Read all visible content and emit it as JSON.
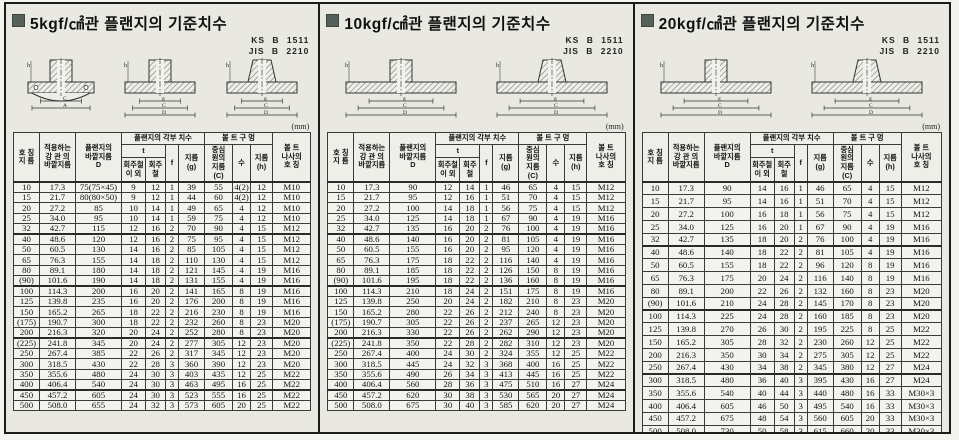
{
  "drawing_labels": {
    "h": "h",
    "g": "g",
    "c": "C",
    "d": "D",
    "a": "A"
  },
  "table_header": {
    "nominal": "호 칭\n지 름",
    "pipe_od": "적용하는\n강 관 의\n바깥지름",
    "flange_od": "플랜지의\n바깥지름\nD",
    "flange_dims_group": "플랜지의 각부 치수",
    "t": "t",
    "t_non_gray_cast": "회주철\n이 외",
    "t_gray_cast": "회주철",
    "f": "f",
    "g": "지름\n(g)",
    "bolt_holes_group": "볼 트 구 멍",
    "bolt_circle": "중심\n원의\n지름\n(C)",
    "count": "수",
    "hole_dia": "지름\n(h)",
    "bolt_thread": "볼 트\n나사의\n호 칭"
  },
  "panels": [
    {
      "title": "5kgf/㎠관 플랜지의 기준치수",
      "standards": [
        "KS B 1511",
        "JIS B 2210"
      ],
      "unit": "(mm)",
      "groups": [
        [
          [
            "10",
            "17.3",
            "75(75×45)",
            "9",
            "12",
            "1",
            "39",
            "55",
            "4(2)",
            "12",
            "M10"
          ],
          [
            "15",
            "21.7",
            "80(80×50)",
            "9",
            "12",
            "1",
            "44",
            "60",
            "4(2)",
            "12",
            "M10"
          ],
          [
            "20",
            "27.2",
            "85",
            "10",
            "14",
            "1",
            "49",
            "65",
            "4",
            "12",
            "M10"
          ],
          [
            "25",
            "34.0",
            "95",
            "10",
            "14",
            "1",
            "59",
            "75",
            "4",
            "12",
            "M10"
          ],
          [
            "32",
            "42.7",
            "115",
            "12",
            "16",
            "2",
            "70",
            "90",
            "4",
            "15",
            "M12"
          ]
        ],
        [
          [
            "40",
            "48.6",
            "120",
            "12",
            "16",
            "2",
            "75",
            "95",
            "4",
            "15",
            "M12"
          ],
          [
            "50",
            "60.5",
            "130",
            "14",
            "16",
            "2",
            "85",
            "105",
            "4",
            "15",
            "M12"
          ],
          [
            "65",
            "76.3",
            "155",
            "14",
            "18",
            "2",
            "110",
            "130",
            "4",
            "15",
            "M12"
          ],
          [
            "80",
            "89.1",
            "180",
            "14",
            "18",
            "2",
            "121",
            "145",
            "4",
            "19",
            "M16"
          ],
          [
            "(90)",
            "101.6",
            "190",
            "14",
            "18",
            "2",
            "131",
            "155",
            "4",
            "19",
            "M16"
          ]
        ],
        [
          [
            "100",
            "114.3",
            "200",
            "16",
            "20",
            "2",
            "141",
            "165",
            "8",
            "19",
            "M16"
          ],
          [
            "125",
            "139.8",
            "235",
            "16",
            "20",
            "2",
            "176",
            "200",
            "8",
            "19",
            "M16"
          ],
          [
            "150",
            "165.2",
            "265",
            "18",
            "22",
            "2",
            "216",
            "230",
            "8",
            "19",
            "M16"
          ],
          [
            "(175)",
            "190.7",
            "300",
            "18",
            "22",
            "2",
            "232",
            "260",
            "8",
            "23",
            "M20"
          ],
          [
            "200",
            "216.3",
            "320",
            "20",
            "24",
            "2",
            "252",
            "280",
            "8",
            "23",
            "M20"
          ]
        ],
        [
          [
            "(225)",
            "241.8",
            "345",
            "20",
            "24",
            "2",
            "277",
            "305",
            "12",
            "23",
            "M20"
          ],
          [
            "250",
            "267.4",
            "385",
            "22",
            "26",
            "2",
            "317",
            "345",
            "12",
            "23",
            "M20"
          ],
          [
            "300",
            "318.5",
            "430",
            "22",
            "28",
            "3",
            "360",
            "390",
            "12",
            "23",
            "M20"
          ],
          [
            "350",
            "355.6",
            "480",
            "24",
            "30",
            "3",
            "403",
            "435",
            "12",
            "25",
            "M22"
          ],
          [
            "400",
            "406.4",
            "540",
            "24",
            "30",
            "3",
            "463",
            "495",
            "16",
            "25",
            "M22"
          ]
        ],
        [
          [
            "450",
            "457.2",
            "605",
            "24",
            "30",
            "3",
            "523",
            "555",
            "16",
            "25",
            "M22"
          ],
          [
            "500",
            "508.0",
            "655",
            "24",
            "32",
            "3",
            "573",
            "605",
            "20",
            "25",
            "M22"
          ]
        ]
      ]
    },
    {
      "title": "10kgf/㎠관 플랜지의 기준치수",
      "standards": [
        "KS B 1511",
        "JIS B 2210"
      ],
      "unit": "(mm)",
      "groups": [
        [
          [
            "10",
            "17.3",
            "90",
            "12",
            "14",
            "1",
            "46",
            "65",
            "4",
            "15",
            "M12"
          ],
          [
            "15",
            "21.7",
            "95",
            "12",
            "16",
            "1",
            "51",
            "70",
            "4",
            "15",
            "M12"
          ],
          [
            "20",
            "27.2",
            "100",
            "14",
            "18",
            "1",
            "56",
            "75",
            "4",
            "15",
            "M12"
          ],
          [
            "25",
            "34.0",
            "125",
            "14",
            "18",
            "1",
            "67",
            "90",
            "4",
            "19",
            "M16"
          ],
          [
            "32",
            "42.7",
            "135",
            "16",
            "20",
            "2",
            "76",
            "100",
            "4",
            "19",
            "M16"
          ]
        ],
        [
          [
            "40",
            "48.6",
            "140",
            "16",
            "20",
            "2",
            "81",
            "105",
            "4",
            "19",
            "M16"
          ],
          [
            "50",
            "60.5",
            "155",
            "16",
            "20",
            "2",
            "95",
            "120",
            "4",
            "19",
            "M16"
          ],
          [
            "65",
            "76.3",
            "175",
            "18",
            "22",
            "2",
            "116",
            "140",
            "4",
            "19",
            "M16"
          ],
          [
            "80",
            "89.1",
            "185",
            "18",
            "22",
            "2",
            "126",
            "150",
            "8",
            "19",
            "M16"
          ],
          [
            "(90)",
            "101.6",
            "195",
            "18",
            "22",
            "2",
            "136",
            "160",
            "8",
            "19",
            "M16"
          ]
        ],
        [
          [
            "100",
            "114.3",
            "210",
            "18",
            "24",
            "2",
            "151",
            "175",
            "8",
            "19",
            "M16"
          ],
          [
            "125",
            "139.8",
            "250",
            "20",
            "24",
            "2",
            "182",
            "210",
            "8",
            "23",
            "M20"
          ],
          [
            "150",
            "165.2",
            "280",
            "22",
            "26",
            "2",
            "212",
            "240",
            "8",
            "23",
            "M20"
          ],
          [
            "(175)",
            "190.7",
            "305",
            "22",
            "26",
            "2",
            "237",
            "265",
            "12",
            "23",
            "M20"
          ],
          [
            "200",
            "216.3",
            "330",
            "22",
            "26",
            "2",
            "262",
            "290",
            "12",
            "23",
            "M20"
          ]
        ],
        [
          [
            "(225)",
            "241.8",
            "350",
            "22",
            "28",
            "2",
            "282",
            "310",
            "12",
            "23",
            "M20"
          ],
          [
            "250",
            "267.4",
            "400",
            "24",
            "30",
            "2",
            "324",
            "355",
            "12",
            "25",
            "M22"
          ],
          [
            "300",
            "318.5",
            "445",
            "24",
            "32",
            "3",
            "368",
            "400",
            "16",
            "25",
            "M22"
          ],
          [
            "350",
            "355.6",
            "490",
            "26",
            "34",
            "3",
            "413",
            "445",
            "16",
            "25",
            "M22"
          ],
          [
            "400",
            "406.4",
            "560",
            "28",
            "36",
            "3",
            "475",
            "510",
            "16",
            "27",
            "M24"
          ]
        ],
        [
          [
            "450",
            "457.2",
            "620",
            "30",
            "38",
            "3",
            "530",
            "565",
            "20",
            "27",
            "M24"
          ],
          [
            "500",
            "508.0",
            "675",
            "30",
            "40",
            "3",
            "585",
            "620",
            "20",
            "27",
            "M24"
          ]
        ]
      ]
    },
    {
      "title": "20kgf/㎠관 플랜지의 기준치수",
      "standards": [
        "KS B 1511",
        "JIS B 2210"
      ],
      "unit": "(mm)",
      "groups": [
        [
          [
            "10",
            "17.3",
            "90",
            "14",
            "16",
            "1",
            "46",
            "65",
            "4",
            "15",
            "M12"
          ],
          [
            "15",
            "21.7",
            "95",
            "14",
            "16",
            "1",
            "51",
            "70",
            "4",
            "15",
            "M12"
          ],
          [
            "20",
            "27.2",
            "100",
            "16",
            "18",
            "1",
            "56",
            "75",
            "4",
            "15",
            "M12"
          ],
          [
            "25",
            "34.0",
            "125",
            "16",
            "20",
            "1",
            "67",
            "90",
            "4",
            "19",
            "M16"
          ],
          [
            "32",
            "42.7",
            "135",
            "18",
            "20",
            "2",
            "76",
            "100",
            "4",
            "19",
            "M16"
          ]
        ],
        [
          [
            "40",
            "48.6",
            "140",
            "18",
            "22",
            "2",
            "81",
            "105",
            "4",
            "19",
            "M16"
          ],
          [
            "50",
            "60.5",
            "155",
            "18",
            "22",
            "2",
            "96",
            "120",
            "8",
            "19",
            "M16"
          ],
          [
            "65",
            "76.3",
            "175",
            "20",
            "24",
            "2",
            "116",
            "140",
            "8",
            "19",
            "M16"
          ],
          [
            "80",
            "89.1",
            "200",
            "22",
            "26",
            "2",
            "132",
            "160",
            "8",
            "23",
            "M20"
          ],
          [
            "(90)",
            "101.6",
            "210",
            "24",
            "28",
            "2",
            "145",
            "170",
            "8",
            "23",
            "M20"
          ]
        ],
        [
          [
            "100",
            "114.3",
            "225",
            "24",
            "28",
            "2",
            "160",
            "185",
            "8",
            "23",
            "M20"
          ],
          [
            "125",
            "139.8",
            "270",
            "26",
            "30",
            "2",
            "195",
            "225",
            "8",
            "25",
            "M22"
          ],
          [
            "150",
            "165.2",
            "305",
            "28",
            "32",
            "2",
            "230",
            "260",
            "12",
            "25",
            "M22"
          ],
          [
            "200",
            "216.3",
            "350",
            "30",
            "34",
            "2",
            "275",
            "305",
            "12",
            "25",
            "M22"
          ],
          [
            "250",
            "267.4",
            "430",
            "34",
            "38",
            "2",
            "345",
            "380",
            "12",
            "27",
            "M24"
          ]
        ],
        [
          [
            "300",
            "318.5",
            "480",
            "36",
            "40",
            "3",
            "395",
            "430",
            "16",
            "27",
            "M24"
          ],
          [
            "350",
            "355.6",
            "540",
            "40",
            "44",
            "3",
            "440",
            "480",
            "16",
            "33",
            "M30×3"
          ],
          [
            "400",
            "406.4",
            "605",
            "46",
            "50",
            "3",
            "495",
            "540",
            "16",
            "33",
            "M30×3"
          ],
          [
            "450",
            "457.2",
            "675",
            "48",
            "54",
            "3",
            "560",
            "605",
            "20",
            "33",
            "M30×3"
          ],
          [
            "500",
            "508.0",
            "730",
            "50",
            "58",
            "3",
            "615",
            "660",
            "20",
            "33",
            "M30×3"
          ]
        ]
      ]
    }
  ]
}
